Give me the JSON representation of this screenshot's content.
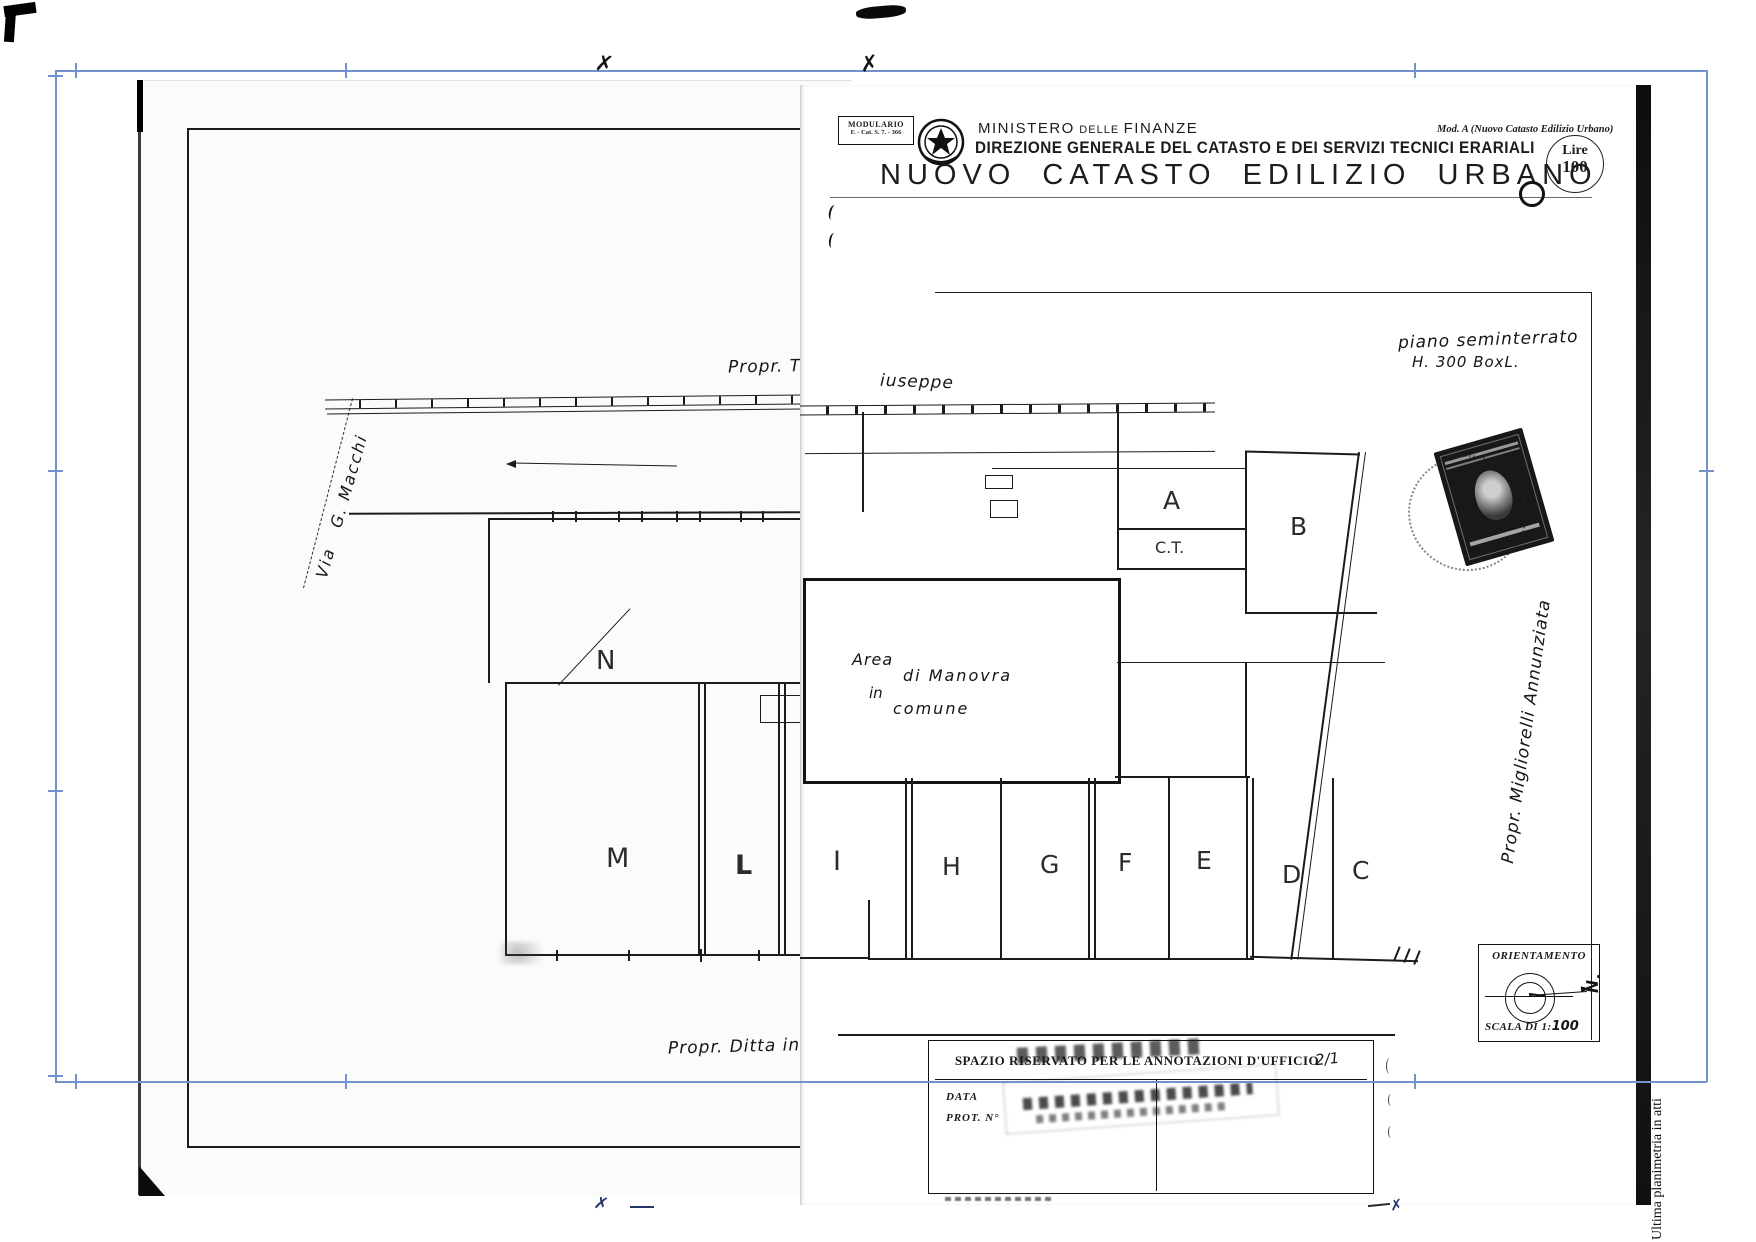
{
  "form": {
    "modulario_title": "MODULARIO",
    "modulario_ref": "F. - Cat. S. 7. - 366",
    "ministry_1": "MINISTERO",
    "ministry_2": "DELLE",
    "ministry_3": "FINANZE",
    "directorate": "DIREZIONE GENERALE DEL CATASTO E DEI SERVIZI TECNICI ERARIALI",
    "title": "NUOVO CATASTO EDILIZIO URBANO",
    "mod_ref": "Mod. A (Nuovo Catasto Edilizio Urbano)",
    "fee_currency": "Lire",
    "fee_amount": "100"
  },
  "plan": {
    "floor_note": "piano seminterrato",
    "floor_dim": "H. 300 BoxL.",
    "owner_top_left": "Propr. Turchetti G",
    "owner_top_right": "iuseppe",
    "street": "Via   G. Macchi",
    "owner_right": "Propr. Migliorelli Annunziata",
    "owner_bottom": "Propr. Ditta intestata",
    "area_word1": "Area",
    "area_word2": "di Manovra",
    "area_word3": "in",
    "area_word4": "comune",
    "rooms": {
      "a": "A",
      "ct": "C.T.",
      "b": "B",
      "n": "N",
      "m": "M",
      "l": "L",
      "i": "I",
      "h": "H",
      "g": "G",
      "f": "F",
      "e": "E",
      "d": "D",
      "c": "C"
    }
  },
  "orientation": {
    "title": "ORIENTAMENTO",
    "north": "N",
    "scale_prefix": "SCALA DI 1:",
    "scale_value": "100"
  },
  "office_box": {
    "title": "SPAZIO RISERVATO PER LE ANNOTAZIONI D'UFFICIO",
    "handwritten": "2/1",
    "date_label": "DATA",
    "prot_label": "PROT. N°"
  },
  "margin": {
    "note": "Ultima planimetria in atti"
  },
  "marks": {
    "cross": "✗"
  },
  "colors": {
    "ink": "#1c1c1c",
    "registration_blue": "#7292cc",
    "paper": "#ffffff"
  }
}
